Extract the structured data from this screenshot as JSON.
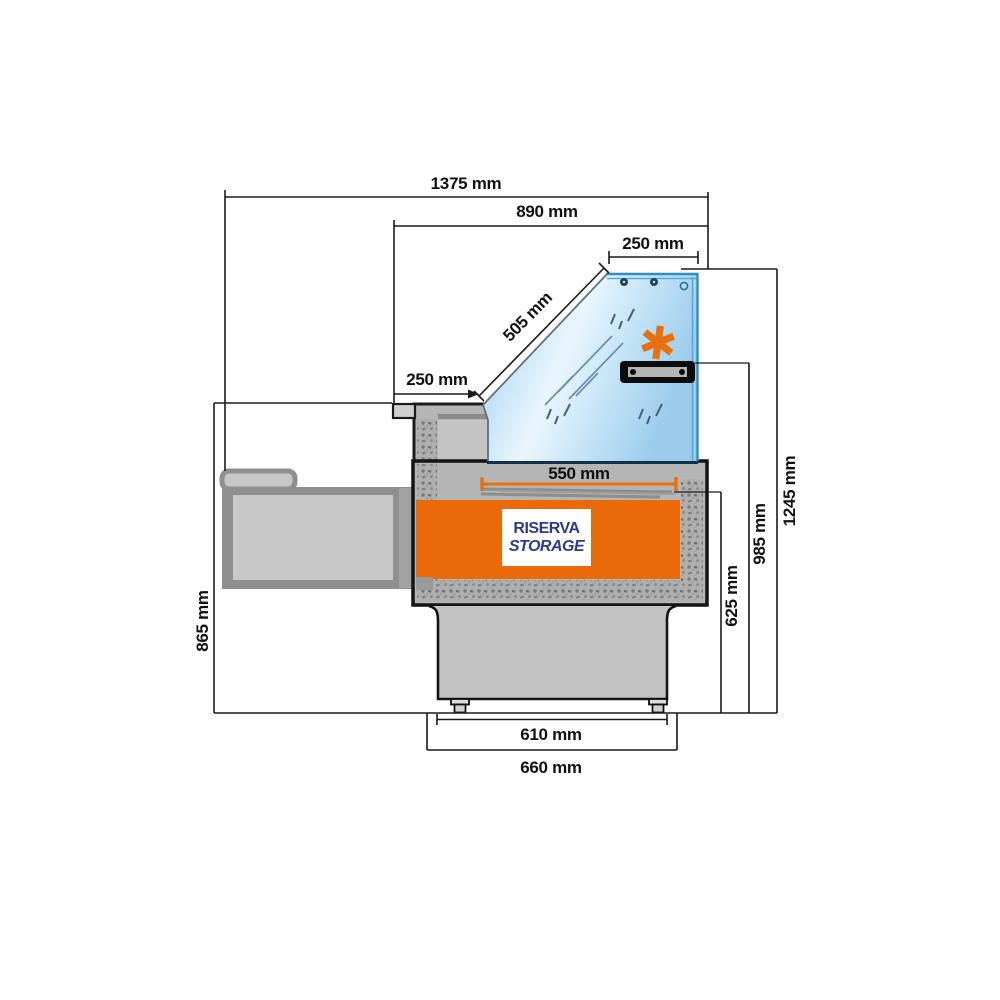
{
  "diagram": {
    "type": "technical-cross-section",
    "subject": "refrigerated serve-over display counter, side section with dimensions"
  },
  "dims": {
    "total_depth": "1375 mm",
    "upper_depth": "890 mm",
    "glass_top_width": "250 mm",
    "glass_slope_length": "505 mm",
    "front_ledge_depth": "250 mm",
    "deck_depth": "550 mm",
    "feet_span": "610 mm",
    "base_depth": "660 mm",
    "worktop_height": "865 mm",
    "reserve_height": "625 mm",
    "lamp_height": "985 mm",
    "overall_height": "1245 mm"
  },
  "storage": {
    "line1": "RISERVA",
    "line2": "STORAGE"
  },
  "icons": {
    "asterisk": "✱"
  },
  "colors": {
    "accent_orange": "#e8700e",
    "storage_orange": "#ea6a09",
    "label_navy": "#2b3990",
    "glass_edge_blue": "#2d8dc6",
    "glass_fill_light": "#d6ecf9",
    "body_gray": "#b5b5b5",
    "outline_black": "#1a1a1a"
  }
}
